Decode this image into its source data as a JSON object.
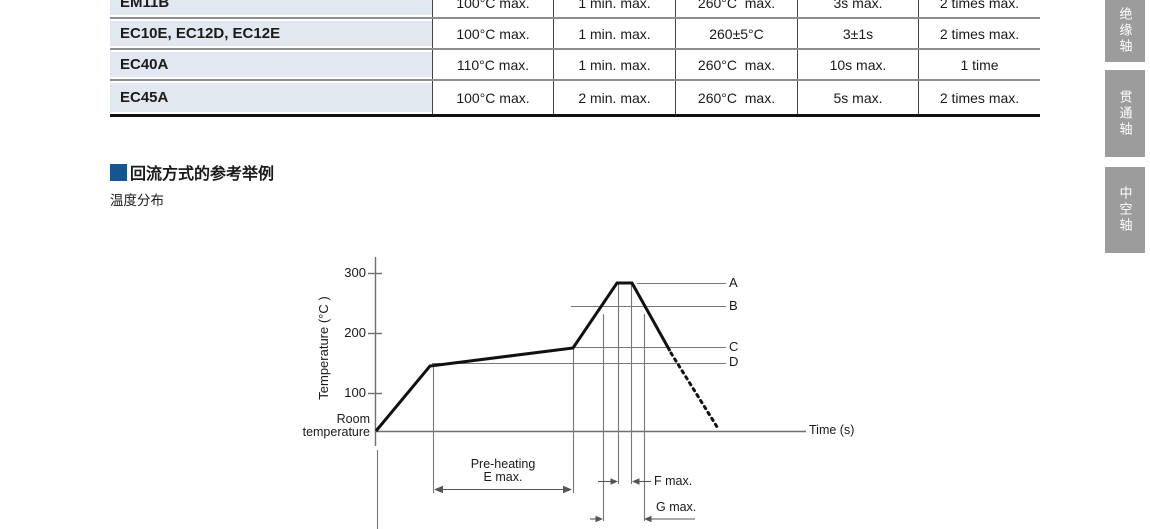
{
  "table": {
    "rows": [
      {
        "model": "EM11B",
        "cells": [
          "100°C max.",
          "1 min. max.",
          "260°C  max.",
          "3s max.",
          "2 times max."
        ]
      },
      {
        "model": "EC10E, EC12D, EC12E",
        "cells": [
          "100°C max.",
          "1 min. max.",
          "260±5°C",
          "3±1s",
          "2 times max."
        ]
      },
      {
        "model": "EC40A",
        "cells": [
          "110°C max.",
          "1 min. max.",
          "260°C  max.",
          "10s max.",
          "1 time"
        ]
      },
      {
        "model": "EC45A",
        "cells": [
          "100°C max.",
          "2 min. max.",
          "260°C  max.",
          "5s max.",
          "2 times max."
        ]
      }
    ]
  },
  "side_tabs": [
    {
      "label": "绝缘轴"
    },
    {
      "label": "贯通轴"
    },
    {
      "label": "中空轴"
    }
  ],
  "section": {
    "title": "回流方式的参考举例",
    "subtitle": "温度分布",
    "accent_color": "#15568f"
  },
  "chart": {
    "y_axis_title": "Temperature (°C )",
    "x_axis_title": "Time (s)",
    "tick_300": "300",
    "tick_200": "200",
    "tick_100": "100",
    "origin_line1": "Room",
    "origin_line2": "temperature",
    "ref_a": "A",
    "ref_b": "B",
    "ref_c": "C",
    "ref_d": "D",
    "preheat_line1": "Pre-heating",
    "preheat_line2": "E max.",
    "f_label": "F max.",
    "g_label": "G max."
  },
  "chart_data": {
    "type": "line",
    "title": "温度分布 (reflow temperature profile, reference example)",
    "xlabel": "Time (s)",
    "ylabel": "Temperature (°C)",
    "y_ticks": [
      100,
      200,
      300
    ],
    "x_ticks": [],
    "x_axis_numeric": false,
    "start_level_label": "Room temperature",
    "series": [
      {
        "name": "reflow-profile",
        "style": "solid heating / dotted cooling",
        "points_relative_time_degC": [
          {
            "x": 0.0,
            "y": "room temperature",
            "note": "start at origin"
          },
          {
            "x": 1.0,
            "y": 155,
            "note": "end of first ramp, level D, pre-heating begins"
          },
          {
            "x": 3.5,
            "y": 175,
            "note": "end of pre-heating (E max. span), level C"
          },
          {
            "x": 4.3,
            "y": 280,
            "note": "peak plateau start, level A"
          },
          {
            "x": 4.6,
            "y": 280,
            "note": "peak plateau end (F max. duration)"
          },
          {
            "x": 5.3,
            "y": 175,
            "note": "solid line ends, cooling shown dotted below"
          },
          {
            "x": 6.2,
            "y": "room temperature",
            "note": "dotted cool-down reaches baseline"
          }
        ]
      }
    ],
    "reference_levels": [
      {
        "label": "A",
        "approx_degC": 280
      },
      {
        "label": "B",
        "approx_degC": 245
      },
      {
        "label": "C",
        "approx_degC": 175
      },
      {
        "label": "D",
        "approx_degC": 155
      }
    ],
    "annotations": [
      "Pre-heating E max.",
      "F max. (time at peak A)",
      "G max. (time above level B)"
    ],
    "grid": false,
    "legend": false
  }
}
